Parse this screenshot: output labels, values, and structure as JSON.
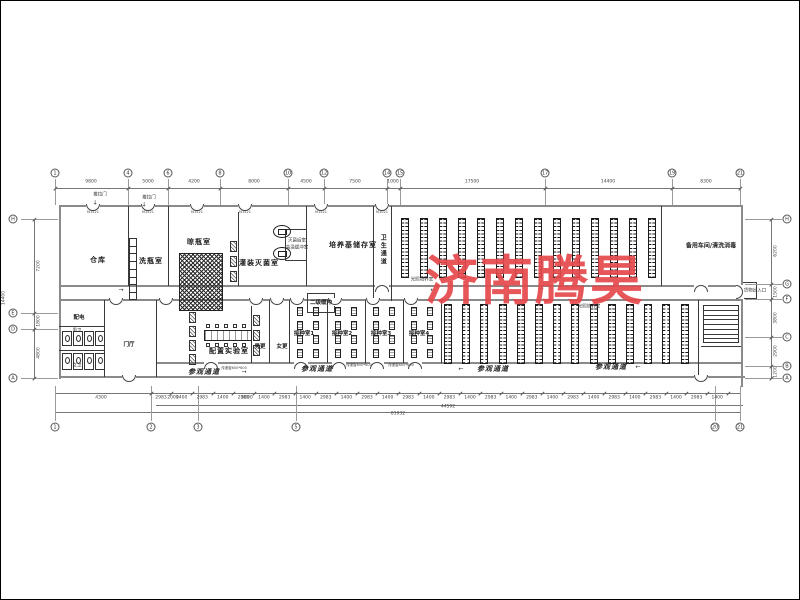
{
  "watermark": {
    "text": "济南腾昊",
    "color": "#e5484c"
  },
  "plan": {
    "labels": [
      {
        "t": "仓库",
        "x": 97,
        "y": 260,
        "cls": "room"
      },
      {
        "t": "洗瓶室",
        "x": 150,
        "y": 261,
        "cls": "room"
      },
      {
        "t": "晾瓶室",
        "x": 198,
        "y": 242,
        "cls": "room"
      },
      {
        "t": "灌装灭菌室",
        "x": 258,
        "y": 263,
        "cls": "room"
      },
      {
        "t": "培养基储存室",
        "x": 352,
        "y": 245,
        "cls": "room"
      },
      {
        "t": "备用车间/清洗消毒",
        "x": 710,
        "y": 246,
        "cls": "room6"
      },
      {
        "t": "配置实验室",
        "x": 228,
        "y": 351,
        "cls": "room"
      },
      {
        "t": "门厅",
        "x": 128,
        "y": 344,
        "cls": "small"
      },
      {
        "t": "配电",
        "x": 78,
        "y": 317,
        "cls": "small"
      },
      {
        "t": "接种室1",
        "x": 303,
        "y": 333,
        "cls": "small"
      },
      {
        "t": "接种室2",
        "x": 341,
        "y": 333,
        "cls": "small"
      },
      {
        "t": "接种室3",
        "x": 380,
        "y": 333,
        "cls": "small"
      },
      {
        "t": "接种室4",
        "x": 418,
        "y": 333,
        "cls": "small"
      },
      {
        "t": "二级缓冲",
        "x": 320,
        "y": 302,
        "cls": "small"
      },
      {
        "t": "男更",
        "x": 259,
        "y": 346,
        "cls": "small"
      },
      {
        "t": "女更",
        "x": 281,
        "y": 346,
        "cls": "small"
      },
      {
        "t": "参观通道",
        "x": 203,
        "y": 372,
        "cls": "corridor"
      },
      {
        "t": "参观通道",
        "x": 316,
        "y": 369,
        "cls": "corridor"
      },
      {
        "t": "参观通道",
        "x": 492,
        "y": 369,
        "cls": "corridor"
      },
      {
        "t": "参观通道",
        "x": 610,
        "y": 367,
        "cls": "corridor"
      },
      {
        "t": "男卫",
        "x": 76,
        "y": 331,
        "cls": "tiny"
      },
      {
        "t": "女卫",
        "x": 76,
        "y": 366,
        "cls": "tiny"
      },
      {
        "t": "灭菌后室",
        "x": 296,
        "y": 241,
        "cls": "tiny"
      },
      {
        "t": "高温缓冲室",
        "x": 296,
        "y": 248,
        "cls": "tiny"
      },
      {
        "t": "光照培养室",
        "x": 421,
        "y": 280,
        "cls": "tiny"
      },
      {
        "t": "光照培养室",
        "x": 588,
        "y": 307,
        "cls": "tiny"
      },
      {
        "t": "推拉门",
        "x": 99,
        "y": 195,
        "cls": "tiny"
      },
      {
        "t": "推拉门",
        "x": 148,
        "y": 198,
        "cls": "tiny"
      },
      {
        "t": "货物出入口",
        "x": 754,
        "y": 291,
        "cls": "tiny"
      },
      {
        "t": "传递窗600*600",
        "x": 233,
        "y": 368,
        "cls": "tiny4"
      },
      {
        "t": "传递窗600*600",
        "x": 358,
        "y": 365,
        "cls": "tiny4"
      },
      {
        "t": "传递窗600*600",
        "x": 400,
        "y": 365,
        "cls": "tiny4"
      },
      {
        "t": "M1521",
        "x": 92,
        "y": 212,
        "cls": "tiny4"
      },
      {
        "t": "M1521",
        "x": 147,
        "y": 212,
        "cls": "tiny4"
      },
      {
        "t": "M1521",
        "x": 196,
        "y": 212,
        "cls": "tiny4"
      },
      {
        "t": "M1521",
        "x": 244,
        "y": 212,
        "cls": "tiny4"
      },
      {
        "t": "M1521",
        "x": 320,
        "y": 212,
        "cls": "tiny4"
      },
      {
        "t": "M1021",
        "x": 381,
        "y": 212,
        "cls": "tiny4"
      },
      {
        "t": "卫生通道",
        "x": 381,
        "y": 249,
        "cls": "vert"
      }
    ],
    "flow_arrows": [
      {
        "t": "→",
        "x": 120,
        "y": 289
      },
      {
        "t": "←",
        "x": 432,
        "y": 289
      },
      {
        "t": "→",
        "x": 540,
        "y": 288
      },
      {
        "t": "→",
        "x": 243,
        "y": 371
      },
      {
        "t": "←",
        "x": 460,
        "y": 368
      },
      {
        "t": "←",
        "x": 637,
        "y": 366
      },
      {
        "t": "↓",
        "x": 94,
        "y": 202
      },
      {
        "t": "↓",
        "x": 143,
        "y": 204
      }
    ],
    "axis_top": {
      "y": 172,
      "dim_y": 187,
      "line": [
        54,
        187,
        686
      ],
      "circles": [
        [
          "1",
          54
        ],
        [
          "4",
          127
        ],
        [
          "6",
          167
        ],
        [
          "8",
          219
        ],
        [
          "10",
          287
        ],
        [
          "12",
          323
        ],
        [
          "14",
          386
        ],
        [
          "15",
          399
        ],
        [
          "17",
          544
        ],
        [
          "19",
          671
        ],
        [
          "21",
          739
        ]
      ],
      "dims": [
        [
          "9800",
          90
        ],
        [
          "5000",
          147
        ],
        [
          "4200",
          193
        ],
        [
          "8000",
          253
        ],
        [
          "4500",
          305
        ],
        [
          "7500",
          354
        ],
        [
          "1000",
          392
        ],
        [
          "17500",
          471
        ],
        [
          "14400",
          607
        ],
        [
          "8300",
          705
        ]
      ]
    },
    "axis_bottom": {
      "y": 426,
      "dim_y": 392,
      "circles": [
        [
          "1",
          54
        ],
        [
          "2",
          150
        ],
        [
          "3",
          197
        ],
        [
          "5",
          295
        ],
        [
          "20",
          714
        ],
        [
          "21",
          739
        ]
      ],
      "dims_left": [
        [
          "4300",
          100
        ],
        [
          "2000",
          172
        ],
        [
          "5000",
          246
        ]
      ],
      "small_dims": {
        "y": 398,
        "start": 160,
        "step": 20.6,
        "values": [
          "2983",
          "1400",
          "2983",
          "1400",
          "2983",
          "1400",
          "2983",
          "1400",
          "2983",
          "1400",
          "2983",
          "1400",
          "2983",
          "1400",
          "2983",
          "1400",
          "2983",
          "1400",
          "2983",
          "1400",
          "2983",
          "1400",
          "2983",
          "1400",
          "2983",
          "1400",
          "2983",
          "1400"
        ]
      },
      "totals": [
        {
          "t": "44592",
          "x": 447,
          "y": 407
        },
        {
          "t": "81932",
          "x": 397,
          "y": 414
        }
      ],
      "lines": [
        [
          54,
          392,
          686
        ],
        [
          155,
          404,
          587
        ],
        [
          54,
          411,
          686
        ]
      ]
    },
    "axis_left": {
      "x": 12,
      "dim_x": 33,
      "circles": [
        [
          "H",
          218
        ],
        [
          "E",
          312
        ],
        [
          "D",
          328
        ],
        [
          "A",
          377
        ]
      ],
      "dims": [
        [
          "7200",
          265
        ],
        [
          "1800",
          320
        ],
        [
          "4800",
          352
        ]
      ],
      "total": {
        "t": "14400",
        "x": 4,
        "y": 297
      }
    },
    "axis_right": {
      "x": 786,
      "dim_x": 770,
      "circles": [
        [
          "H",
          218
        ],
        [
          "G",
          283
        ],
        [
          "F",
          298
        ],
        [
          "C",
          336
        ],
        [
          "B",
          365
        ],
        [
          "A",
          377
        ]
      ],
      "dims": [
        [
          "6200",
          250
        ],
        [
          "1500",
          291
        ],
        [
          "3800",
          317
        ],
        [
          "2900",
          350
        ],
        [
          "1200",
          371
        ]
      ]
    },
    "walls_thick": [
      [
        60,
        204,
        682,
        2.4
      ],
      [
        58,
        204,
        2.4,
        174
      ],
      [
        740,
        204,
        2.4,
        182
      ],
      [
        58,
        375,
        686,
        2.4
      ],
      [
        60,
        284,
        682,
        1.6
      ],
      [
        60,
        298,
        682,
        1.6
      ],
      [
        155,
        361,
        587,
        1.6
      ]
    ],
    "walls_thin": [
      [
        127,
        205,
        1,
        80
      ],
      [
        167,
        205,
        1,
        80
      ],
      [
        237,
        205,
        1,
        80
      ],
      [
        305,
        205,
        1,
        80
      ],
      [
        372,
        205,
        1,
        95
      ],
      [
        390,
        205,
        1,
        95
      ],
      [
        660,
        205,
        1,
        80
      ],
      [
        103,
        299,
        1,
        77
      ],
      [
        155,
        299,
        1,
        77
      ],
      [
        250,
        299,
        1,
        63
      ],
      [
        268,
        299,
        1,
        63
      ],
      [
        288,
        299,
        1,
        63
      ],
      [
        326,
        299,
        1,
        63
      ],
      [
        364,
        299,
        1,
        63
      ],
      [
        402,
        299,
        1,
        63
      ],
      [
        440,
        299,
        1,
        63
      ],
      [
        697,
        299,
        1,
        77
      ],
      [
        58,
        325,
        45,
        1
      ],
      [
        58,
        349,
        45,
        1
      ],
      [
        700,
        345,
        40,
        1
      ],
      [
        306,
        292,
        28,
        1
      ],
      [
        306,
        311,
        28,
        1
      ],
      [
        306,
        292,
        1,
        19
      ],
      [
        333,
        292,
        1,
        19
      ],
      [
        284,
        228,
        21,
        1
      ],
      [
        284,
        259,
        21,
        1
      ],
      [
        284,
        228,
        1,
        32
      ],
      [
        742,
        281,
        14,
        1
      ],
      [
        742,
        297,
        14,
        1
      ],
      [
        755,
        281,
        1,
        17
      ]
    ],
    "doors": [
      [
        92,
        203,
        "d"
      ],
      [
        147,
        203,
        "d"
      ],
      [
        196,
        203,
        "d"
      ],
      [
        244,
        203,
        "d"
      ],
      [
        320,
        203,
        "d"
      ],
      [
        381,
        203,
        "d"
      ],
      [
        381,
        283,
        "u"
      ],
      [
        700,
        283,
        "u"
      ],
      [
        115,
        297,
        "d"
      ],
      [
        165,
        297,
        "d"
      ],
      [
        255,
        297,
        "d"
      ],
      [
        276,
        297,
        "d"
      ],
      [
        296,
        297,
        "d"
      ],
      [
        334,
        297,
        "d"
      ],
      [
        372,
        297,
        "d"
      ],
      [
        410,
        297,
        "d"
      ],
      [
        210,
        360,
        "u"
      ],
      [
        300,
        360,
        "u"
      ],
      [
        338,
        360,
        "u"
      ],
      [
        376,
        360,
        "u"
      ],
      [
        414,
        360,
        "u"
      ],
      [
        128,
        374,
        "d"
      ],
      [
        700,
        374,
        "d"
      ],
      [
        739,
        287,
        "r"
      ]
    ],
    "racks": [
      {
        "x": 400,
        "y": 217,
        "h": 60,
        "cols": 14,
        "colw": 8,
        "pitch": 19
      },
      {
        "x": 443,
        "y": 303,
        "h": 60,
        "cols": 14,
        "colw": 8,
        "pitch": 18.2
      }
    ],
    "crosshatch": {
      "x": 178,
      "y": 252,
      "w": 44,
      "h": 58
    },
    "ladder": {
      "x": 128,
      "y": 237,
      "w": 8,
      "cells": 8,
      "cellh": 7.7
    },
    "stairs": {
      "x": 702,
      "y": 304,
      "w": 36,
      "h": 38,
      "steps": 8
    },
    "toilets": {
      "x0": 61,
      "pitch": 11,
      "count": 4,
      "rows": [
        [
          330,
          15
        ],
        [
          352,
          17
        ]
      ]
    },
    "bench": {
      "x": 203,
      "y": 329,
      "w": 48,
      "h": 11,
      "stool_x0": 205,
      "stool_step": 9,
      "stool_n": 5,
      "stool_ys": [
        323,
        342
      ]
    },
    "autoclaves": [
      [
        272,
        224
      ],
      [
        272,
        246
      ]
    ],
    "hatch_boxes": [
      [
        229,
        240
      ],
      [
        229,
        255
      ],
      [
        229,
        270
      ],
      [
        188,
        311
      ],
      [
        188,
        325
      ],
      [
        188,
        339
      ],
      [
        188,
        353
      ],
      [
        252,
        314
      ],
      [
        252,
        329
      ],
      [
        252,
        344
      ]
    ],
    "inoculation": {
      "rooms_x": [
        290,
        328,
        366,
        404
      ],
      "col_off": [
        6,
        22
      ],
      "rows_y": [
        306,
        320,
        334,
        348
      ]
    }
  }
}
